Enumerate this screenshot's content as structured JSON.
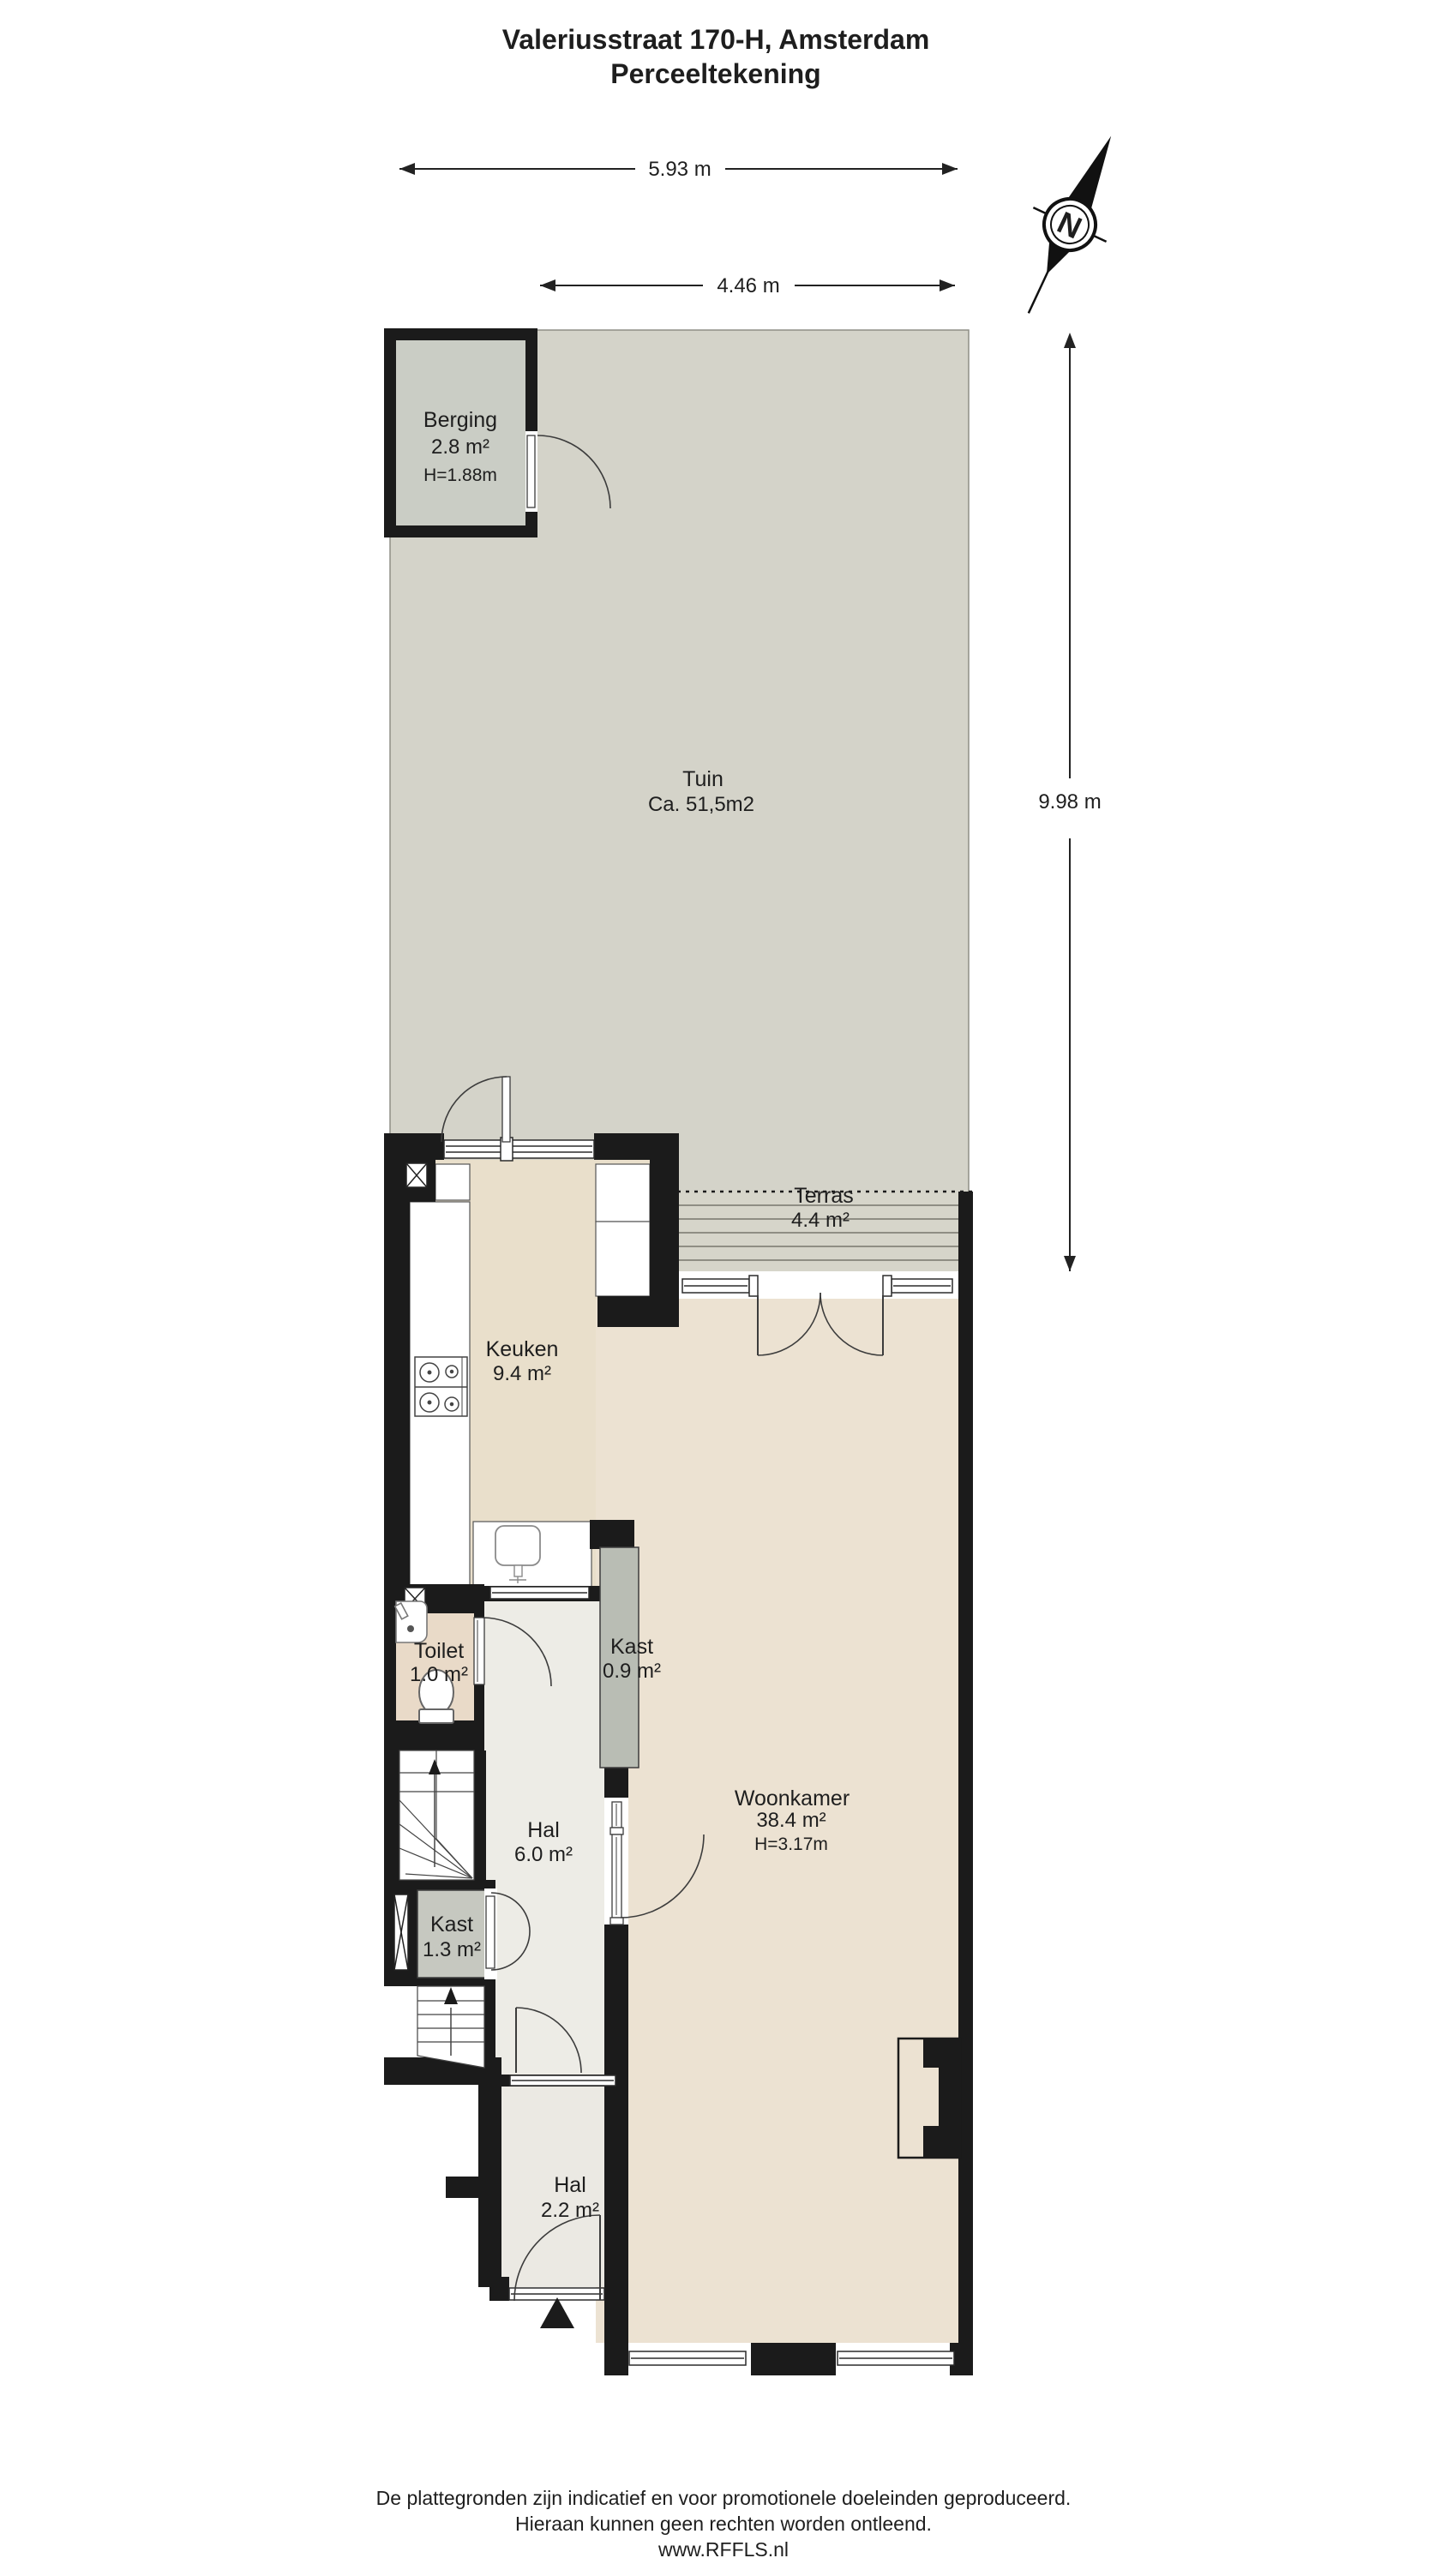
{
  "title": {
    "line1": "Valeriusstraat 170-H, Amsterdam",
    "line2": "Perceeltekening"
  },
  "dimensions": {
    "total_width": "5.93 m",
    "garden_width": "4.46 m",
    "garden_depth": "9.98 m"
  },
  "compass": {
    "north_label": "N"
  },
  "rooms": {
    "berging": {
      "name": "Berging",
      "area": "2.8 m²",
      "ceiling": "H=1.88m"
    },
    "tuin": {
      "name": "Tuin",
      "area": "Ca. 51,5m2"
    },
    "terras": {
      "name": "Terras",
      "area": "4.4 m²"
    },
    "keuken": {
      "name": "Keuken",
      "area": "9.4 m²"
    },
    "toilet": {
      "name": "Toilet",
      "area": "1.0 m²"
    },
    "kast_woonkamer": {
      "name": "Kast",
      "area": "0.9 m²"
    },
    "hal": {
      "name": "Hal",
      "area": "6.0 m²"
    },
    "kast_hal": {
      "name": "Kast",
      "area": "1.3 m²"
    },
    "woonkamer": {
      "name": "Woonkamer",
      "area": "38.4 m²",
      "ceiling": "H=3.17m"
    },
    "entree_hal": {
      "name": "Hal",
      "area": "2.2 m²"
    }
  },
  "footer": {
    "line1": "De plattegronden zijn indicatief en voor promotionele doeleinden geproduceerd.",
    "line2": "Hieraan kunnen geen rechten worden ontleend.",
    "line3": "www.RFFLS.nl"
  },
  "colors": {
    "wall": "#1b1b1b",
    "garden": "#d4d3c9",
    "shed_floor": "#cacdc5",
    "terrace": "#d6d5ca",
    "terrace_stripe": "#8f8e84",
    "kitchen_floor": "#e9dfcb",
    "living_floor": "#ece2d2",
    "hall_floor": "#edece6",
    "entry_floor": "#ebe9e3",
    "toilet_floor": "#e9dac8",
    "closet_small": "#b9bdb4",
    "closet_large": "#c6c8c0"
  }
}
